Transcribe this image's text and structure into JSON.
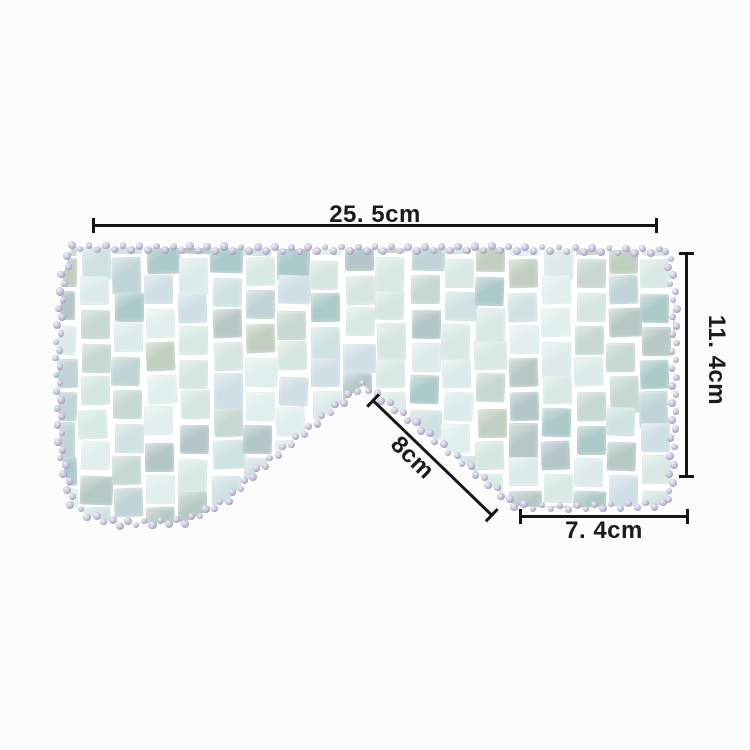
{
  "image": {
    "background": "#fcfcfc",
    "subject": "jade-tile-eye-mask"
  },
  "annotations": {
    "line_color": "#151515",
    "text_color": "#1b1b1b",
    "top_width_label": "25. 5cm",
    "right_height_label": "11. 4cm",
    "nose_bridge_label": "8cm",
    "bottom_right_width_label": "7. 4cm"
  },
  "artwork": {
    "tile_palette": [
      "#cfe2e2",
      "#bfd4d6",
      "#d6e6e0",
      "#accac9",
      "#c6d8cf",
      "#e1efec",
      "#b7c9c4",
      "#dcebe9",
      "#c2cfc0",
      "#cfdfe6",
      "#d9e9e4",
      "#b3c6c8"
    ],
    "tile_gap_color": "#ffffff",
    "bead_highlight": "#f0eef8",
    "bead_mid": "#c7c2da",
    "bead_dark": "#9d97ba"
  }
}
